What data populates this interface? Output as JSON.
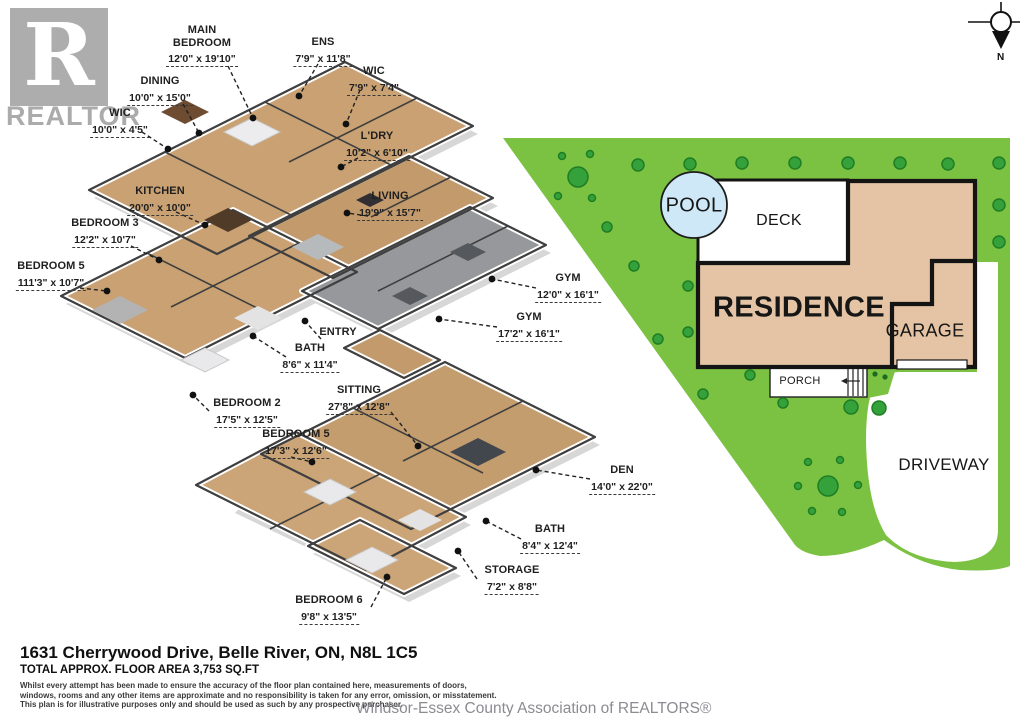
{
  "watermark": {
    "logo_letter": "R",
    "logo_text": "REALTOR",
    "association": "Windsor-Essex County Association of REALTORS®"
  },
  "compass": {
    "north": "N"
  },
  "floorplan": {
    "rooms": [
      {
        "name": "MAIN BEDROOM",
        "dims": "12'0\" x 19'10\""
      },
      {
        "name": "ENS",
        "dims": "7'9\" x 11'8\""
      },
      {
        "name": "DINING",
        "dims": "10'0\" x 15'0\""
      },
      {
        "name": "WIC",
        "dims": "10'0\" x 4'5\""
      },
      {
        "name": "WIC",
        "dims": "7'9\" x 7'4\""
      },
      {
        "name": "L'DRY",
        "dims": "10'2\" x 6'10\""
      },
      {
        "name": "KITCHEN",
        "dims": "20'0\" x 10'0\""
      },
      {
        "name": "LIVING",
        "dims": "19'9\" x 15'7\""
      },
      {
        "name": "BEDROOM 3",
        "dims": "12'2\" x 10'7\""
      },
      {
        "name": "BEDROOM 5",
        "dims": "111'3\" x 10'7\""
      },
      {
        "name": "GYM",
        "dims": "12'0\" x 16'1\""
      },
      {
        "name": "GYM",
        "dims": "17'2\" x 16'1\""
      },
      {
        "name": "ENTRY",
        "dims": ""
      },
      {
        "name": "BATH",
        "dims": "8'6\" x 11'4\""
      },
      {
        "name": "SITTING",
        "dims": "27'8\" x 12'8\""
      },
      {
        "name": "BEDROOM 2",
        "dims": "17'5\" x 12'5\""
      },
      {
        "name": "BEDROOM 5",
        "dims": "17'3\" x 12'6\""
      },
      {
        "name": "DEN",
        "dims": "14'0\" x 22'0\""
      },
      {
        "name": "BATH",
        "dims": "8'4\" x 12'4\""
      },
      {
        "name": "STORAGE",
        "dims": "7'2\" x 8'8\""
      },
      {
        "name": "BEDROOM 6",
        "dims": "9'8\" x 13'5\""
      }
    ]
  },
  "siteplan": {
    "pool": "POOL",
    "deck": "DECK",
    "residence": "RESIDENCE",
    "garage": "GARAGE",
    "porch": "PORCH",
    "driveway": "DRIVEWAY",
    "colors": {
      "lawn": "#7cc242",
      "tree": "#35a13a",
      "tree_outline": "#1f7d24",
      "pool": "#cfe8f7",
      "building": "#e4c4a4",
      "outline": "#141414",
      "wood_floor": "#c7a376",
      "gym_floor": "#96989b"
    }
  },
  "footer": {
    "address": "1631 Cherrywood Drive, Belle River, ON, N8L 1C5",
    "area": "TOTAL APPROX. FLOOR AREA 3,753 SQ.FT",
    "disclaimer": [
      "Whilst every attempt has been made to ensure the accuracy of the floor plan contained here, measurements of doors,",
      "windows, rooms and any other items are approximate and no responsibility is taken for any error, omission, or misstatement.",
      "This plan is for illustrative purposes only and should be used as such by any prospective purchaser."
    ]
  }
}
